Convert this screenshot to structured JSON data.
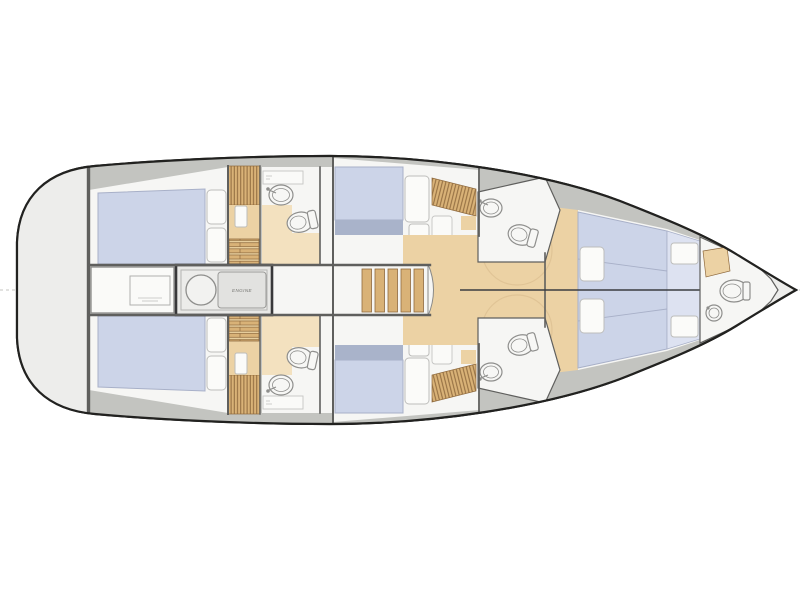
{
  "figure": {
    "title": "Sailing yacht interior layout plan",
    "view": "top-down deck plan",
    "bow_direction": "right",
    "symmetry": "port and starboard halves mirrored about centerline"
  },
  "labels": {
    "engine": "ENGINE"
  },
  "colors": {
    "hullline": "#222220",
    "hullfill": "#f8f8f6",
    "deck": "#c3c4c0",
    "platform": "#ededeb",
    "room": "#f6f6f4",
    "wall": "#5f5f5d",
    "bed": "#ccd4e8",
    "bedband": "#a9b3ca",
    "bedlight": "#dde2f1",
    "bedline": "#a8b0c8",
    "wood": "#d9b277",
    "woodline": "#8f6a3e",
    "woodfloor": "#ecd2a4",
    "tanfloor": "#f3e1bf",
    "fixline": "#8e8e8c",
    "arc": "#ddc092",
    "seam": "#3b3d41"
  },
  "rooms": [
    {
      "name": "stern platform",
      "features": []
    },
    {
      "name": "aft cabin port",
      "features": [
        "double berth",
        "pillows",
        "hanging locker",
        "access steps"
      ]
    },
    {
      "name": "aft head port",
      "features": [
        "washbasin",
        "toilet",
        "counter"
      ]
    },
    {
      "name": "aft cabin starboard",
      "features": [
        "double berth",
        "pillows",
        "hanging locker",
        "access steps"
      ]
    },
    {
      "name": "aft head starboard",
      "features": [
        "washbasin",
        "toilet",
        "counter"
      ]
    },
    {
      "name": "engine room",
      "features": [
        "engine block",
        "round tank",
        "storage locker"
      ]
    },
    {
      "name": "companionway",
      "features": [
        "5-step ladder"
      ]
    },
    {
      "name": "saloon",
      "features": [
        "wood sole"
      ]
    },
    {
      "name": "mid cabin port",
      "features": [
        "double berth",
        "pillows",
        "slatted wardrobe"
      ]
    },
    {
      "name": "mid head port",
      "features": [
        "washbasin",
        "toilet"
      ]
    },
    {
      "name": "mid cabin starboard",
      "features": [
        "double berth",
        "pillows",
        "slatted wardrobe"
      ]
    },
    {
      "name": "mid head starboard",
      "features": [
        "washbasin",
        "toilet"
      ]
    },
    {
      "name": "forward cabin port",
      "features": [
        "berth",
        "pillow",
        "bench"
      ]
    },
    {
      "name": "forward cabin starboard",
      "features": [
        "berth",
        "pillow",
        "bench"
      ]
    },
    {
      "name": "bow head",
      "features": [
        "toilet",
        "washbasin",
        "cabinet"
      ]
    }
  ]
}
